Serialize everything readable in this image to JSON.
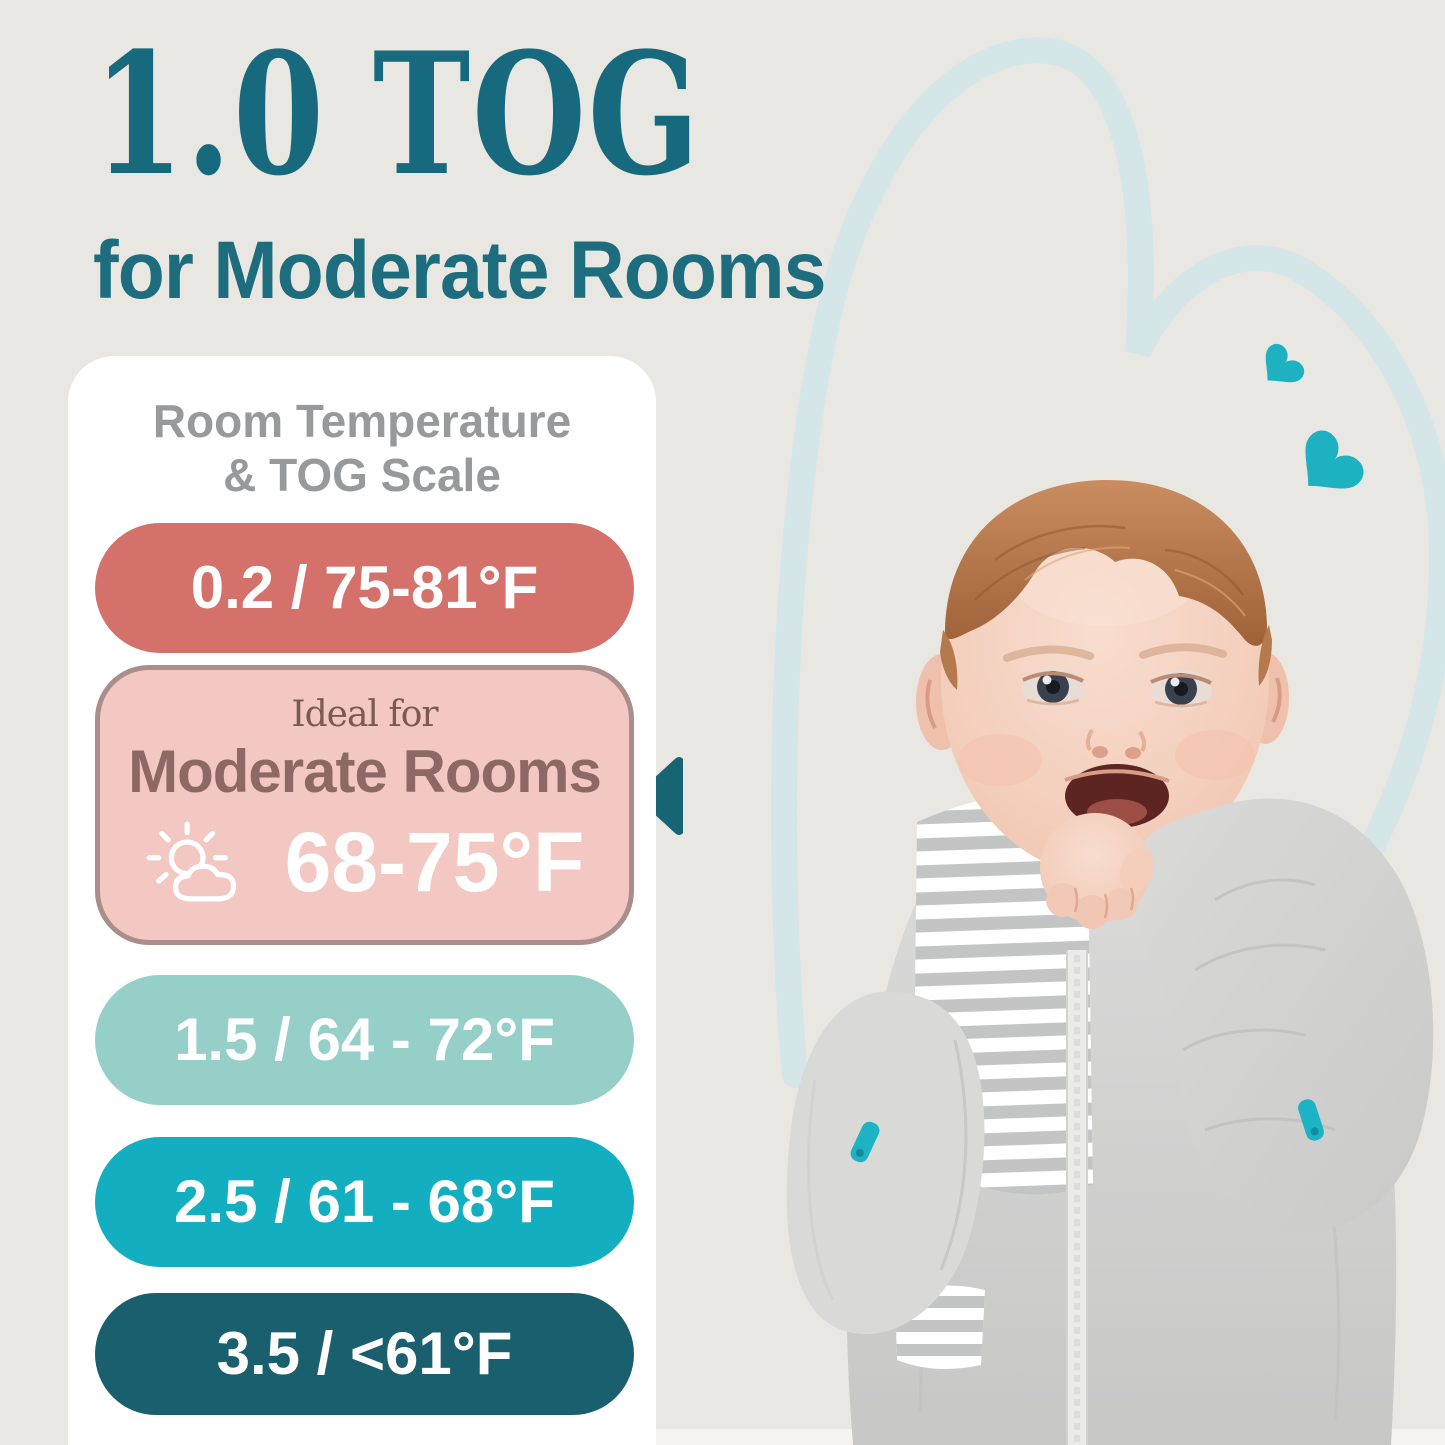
{
  "header": {
    "title": "1.0 TOG",
    "subtitle": "for Moderate Rooms",
    "title_color": "#17697d",
    "subtitle_color": "#1d6d7e"
  },
  "panel": {
    "bg": "#ffffff",
    "heading": {
      "line1": "Room Temperature",
      "line2": "& TOG Scale",
      "color": "#97999b"
    },
    "pills": [
      {
        "label": "0.2 / 75-81°F",
        "bg": "#d5716b"
      },
      {
        "label": "1.5 / 64 - 72°F",
        "bg": "#95cfc7"
      },
      {
        "label": "2.5 / 61 - 68°F",
        "bg": "#13aebf"
      },
      {
        "label": "3.5 / <61°F",
        "bg": "#1a5f6d"
      }
    ],
    "highlight": {
      "pretitle": "Ideal for",
      "room_type": "Moderate Rooms",
      "temperature": "68-75°F",
      "bg": "#f3c7c2",
      "border": "#a98e8b",
      "pretitle_color": "#7a5a53",
      "room_type_color": "#8d6965",
      "icon": "sun-behind-cloud"
    }
  },
  "decor": {
    "background": "#e9e7e1",
    "accent_teal": "#1db1c1",
    "arrow_color": "#176474",
    "heart_outline_color": "#d5e6e9",
    "backdrop_strip": "#f4f3f0"
  },
  "photo": {
    "alt": "Smiling baby lying down wearing a gray swaddle sleep sack with arms up and hand in mouth"
  }
}
